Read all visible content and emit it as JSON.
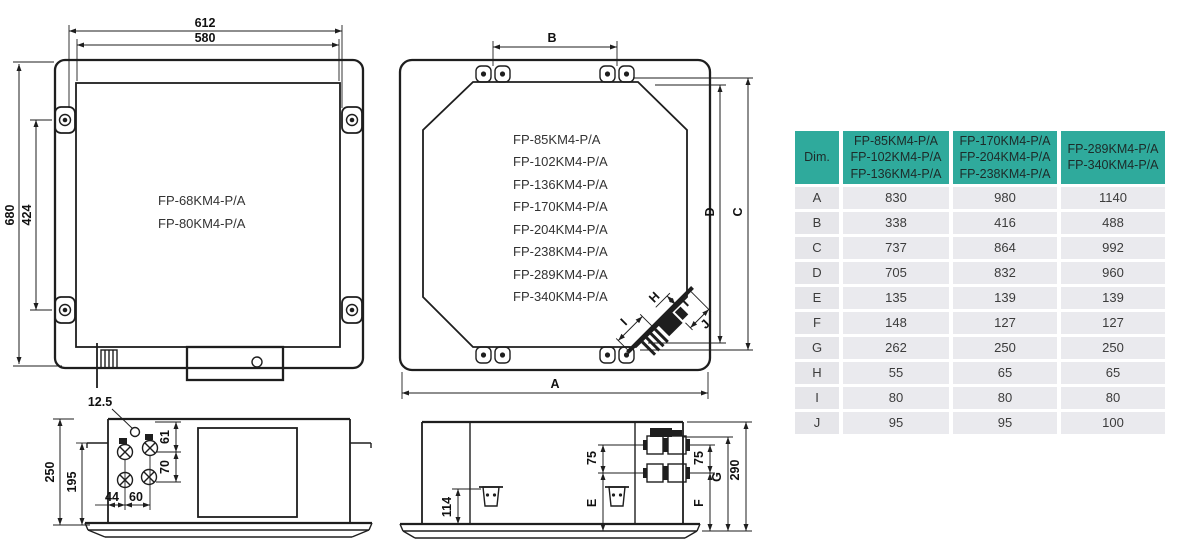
{
  "colors": {
    "line": "#1e1e1e",
    "table_header_bg": "#2faa9c",
    "table_row_bg": "#eaeaee",
    "table_label_bg": "#e6e6ea"
  },
  "front_view": {
    "models": [
      "FP-68KM4-P/A",
      "FP-80KM4-P/A"
    ],
    "dims": {
      "outer_width": "612",
      "panel_width": "580",
      "outer_height": "680",
      "bracket_span": "424"
    }
  },
  "plan_view": {
    "models": [
      "FP-85KM4-P/A",
      "FP-102KM4-P/A",
      "FP-136KM4-P/A",
      "FP-170KM4-P/A",
      "FP-204KM4-P/A",
      "FP-238KM4-P/A",
      "FP-289KM4-P/A",
      "FP-340KM4-P/A"
    ],
    "dims": {
      "a": "A",
      "b": "B",
      "c": "C",
      "d": "D",
      "h": "H",
      "i": "I",
      "j": "J"
    }
  },
  "side_view_left": {
    "dims": {
      "hole": "12.5",
      "d61": "61",
      "d70": "70",
      "d250": "250",
      "d195": "195",
      "d44": "44",
      "d60": "60"
    }
  },
  "side_view_mid": {
    "dims": {
      "d114": "114",
      "e": "E",
      "d75_left": "75",
      "d75_right": "75",
      "f": "F",
      "g": "G",
      "d290": "290"
    }
  },
  "table": {
    "col_headers": [
      "Dim.",
      "FP-85KM4-P/A\nFP-102KM4-P/A\nFP-136KM4-P/A",
      "FP-170KM4-P/A\nFP-204KM4-P/A\nFP-238KM4-P/A",
      "FP-289KM4-P/A\nFP-340KM4-P/A"
    ],
    "rows": [
      {
        "dim": "A",
        "v1": "830",
        "v2": "980",
        "v3": "1140"
      },
      {
        "dim": "B",
        "v1": "338",
        "v2": "416",
        "v3": "488"
      },
      {
        "dim": "C",
        "v1": "737",
        "v2": "864",
        "v3": "992"
      },
      {
        "dim": "D",
        "v1": "705",
        "v2": "832",
        "v3": "960"
      },
      {
        "dim": "E",
        "v1": "135",
        "v2": "139",
        "v3": "139"
      },
      {
        "dim": "F",
        "v1": "148",
        "v2": "127",
        "v3": "127"
      },
      {
        "dim": "G",
        "v1": "262",
        "v2": "250",
        "v3": "250"
      },
      {
        "dim": "H",
        "v1": "55",
        "v2": "65",
        "v3": "65"
      },
      {
        "dim": "I",
        "v1": "80",
        "v2": "80",
        "v3": "80"
      },
      {
        "dim": "J",
        "v1": "95",
        "v2": "95",
        "v3": "100"
      }
    ]
  }
}
